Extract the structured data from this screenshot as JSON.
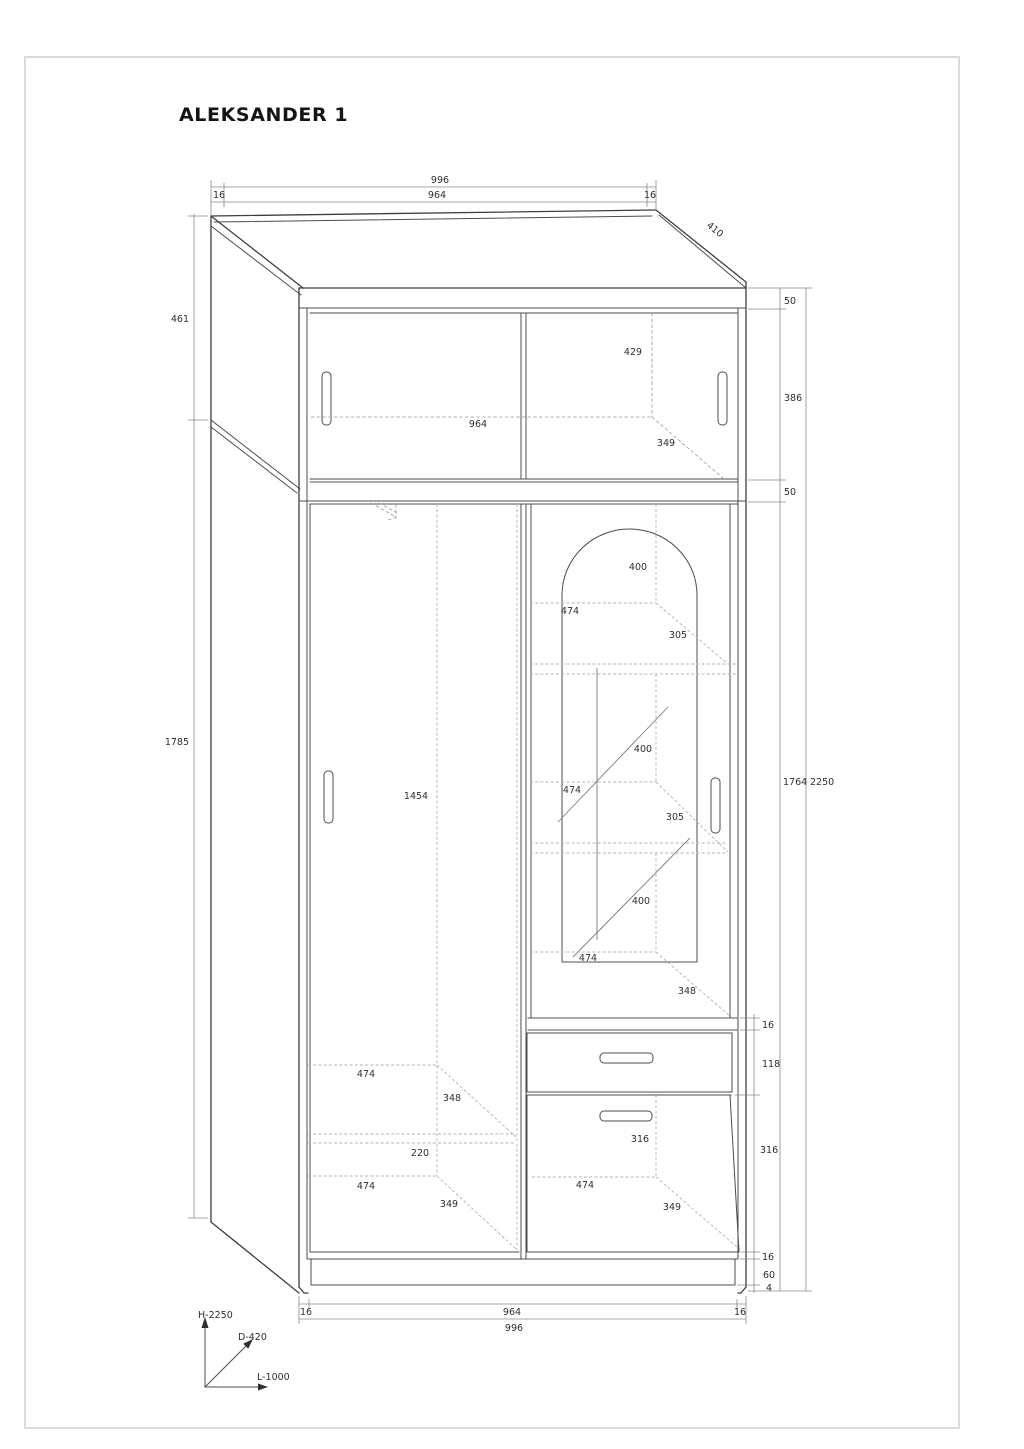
{
  "title": "ALEKSANDER 1",
  "axes": {
    "height": "H-2250",
    "depth": "D-420",
    "length": "L-1000"
  },
  "dims": {
    "top": {
      "overall": "996",
      "inner": "964",
      "gap_left": "16",
      "gap_right": "16",
      "top_depth": "410"
    },
    "bottom": {
      "overall": "996",
      "inner": "964",
      "gap_left": "16",
      "gap_right": "16"
    },
    "left": {
      "upper_side": "461",
      "lower_side": "1785"
    },
    "right": {
      "top_rail": "50",
      "upper_door": "386",
      "bottom_rail": "50",
      "body_height": "1764",
      "total_height": "2250",
      "shelf_thk": "16",
      "drawer_front": "118",
      "lower_door": "316",
      "base_thk": "16",
      "plinth": "60",
      "foot": "4"
    },
    "upper_cabinet": {
      "inner_width": "964",
      "inner_height": "429",
      "inner_depth": "349"
    },
    "left_section": {
      "door_height": "1454",
      "shelf_width": "474",
      "shelf_depth": "348",
      "gap": "220",
      "bottom_width": "474",
      "bottom_depth": "349"
    },
    "right_section": {
      "h1": "400",
      "w1": "474",
      "d1": "305",
      "h2": "400",
      "w2": "474",
      "d2": "305",
      "h3": "400",
      "w3": "474",
      "d3": "348",
      "door_width": "316",
      "bottom_width": "474",
      "bottom_depth": "349"
    }
  }
}
